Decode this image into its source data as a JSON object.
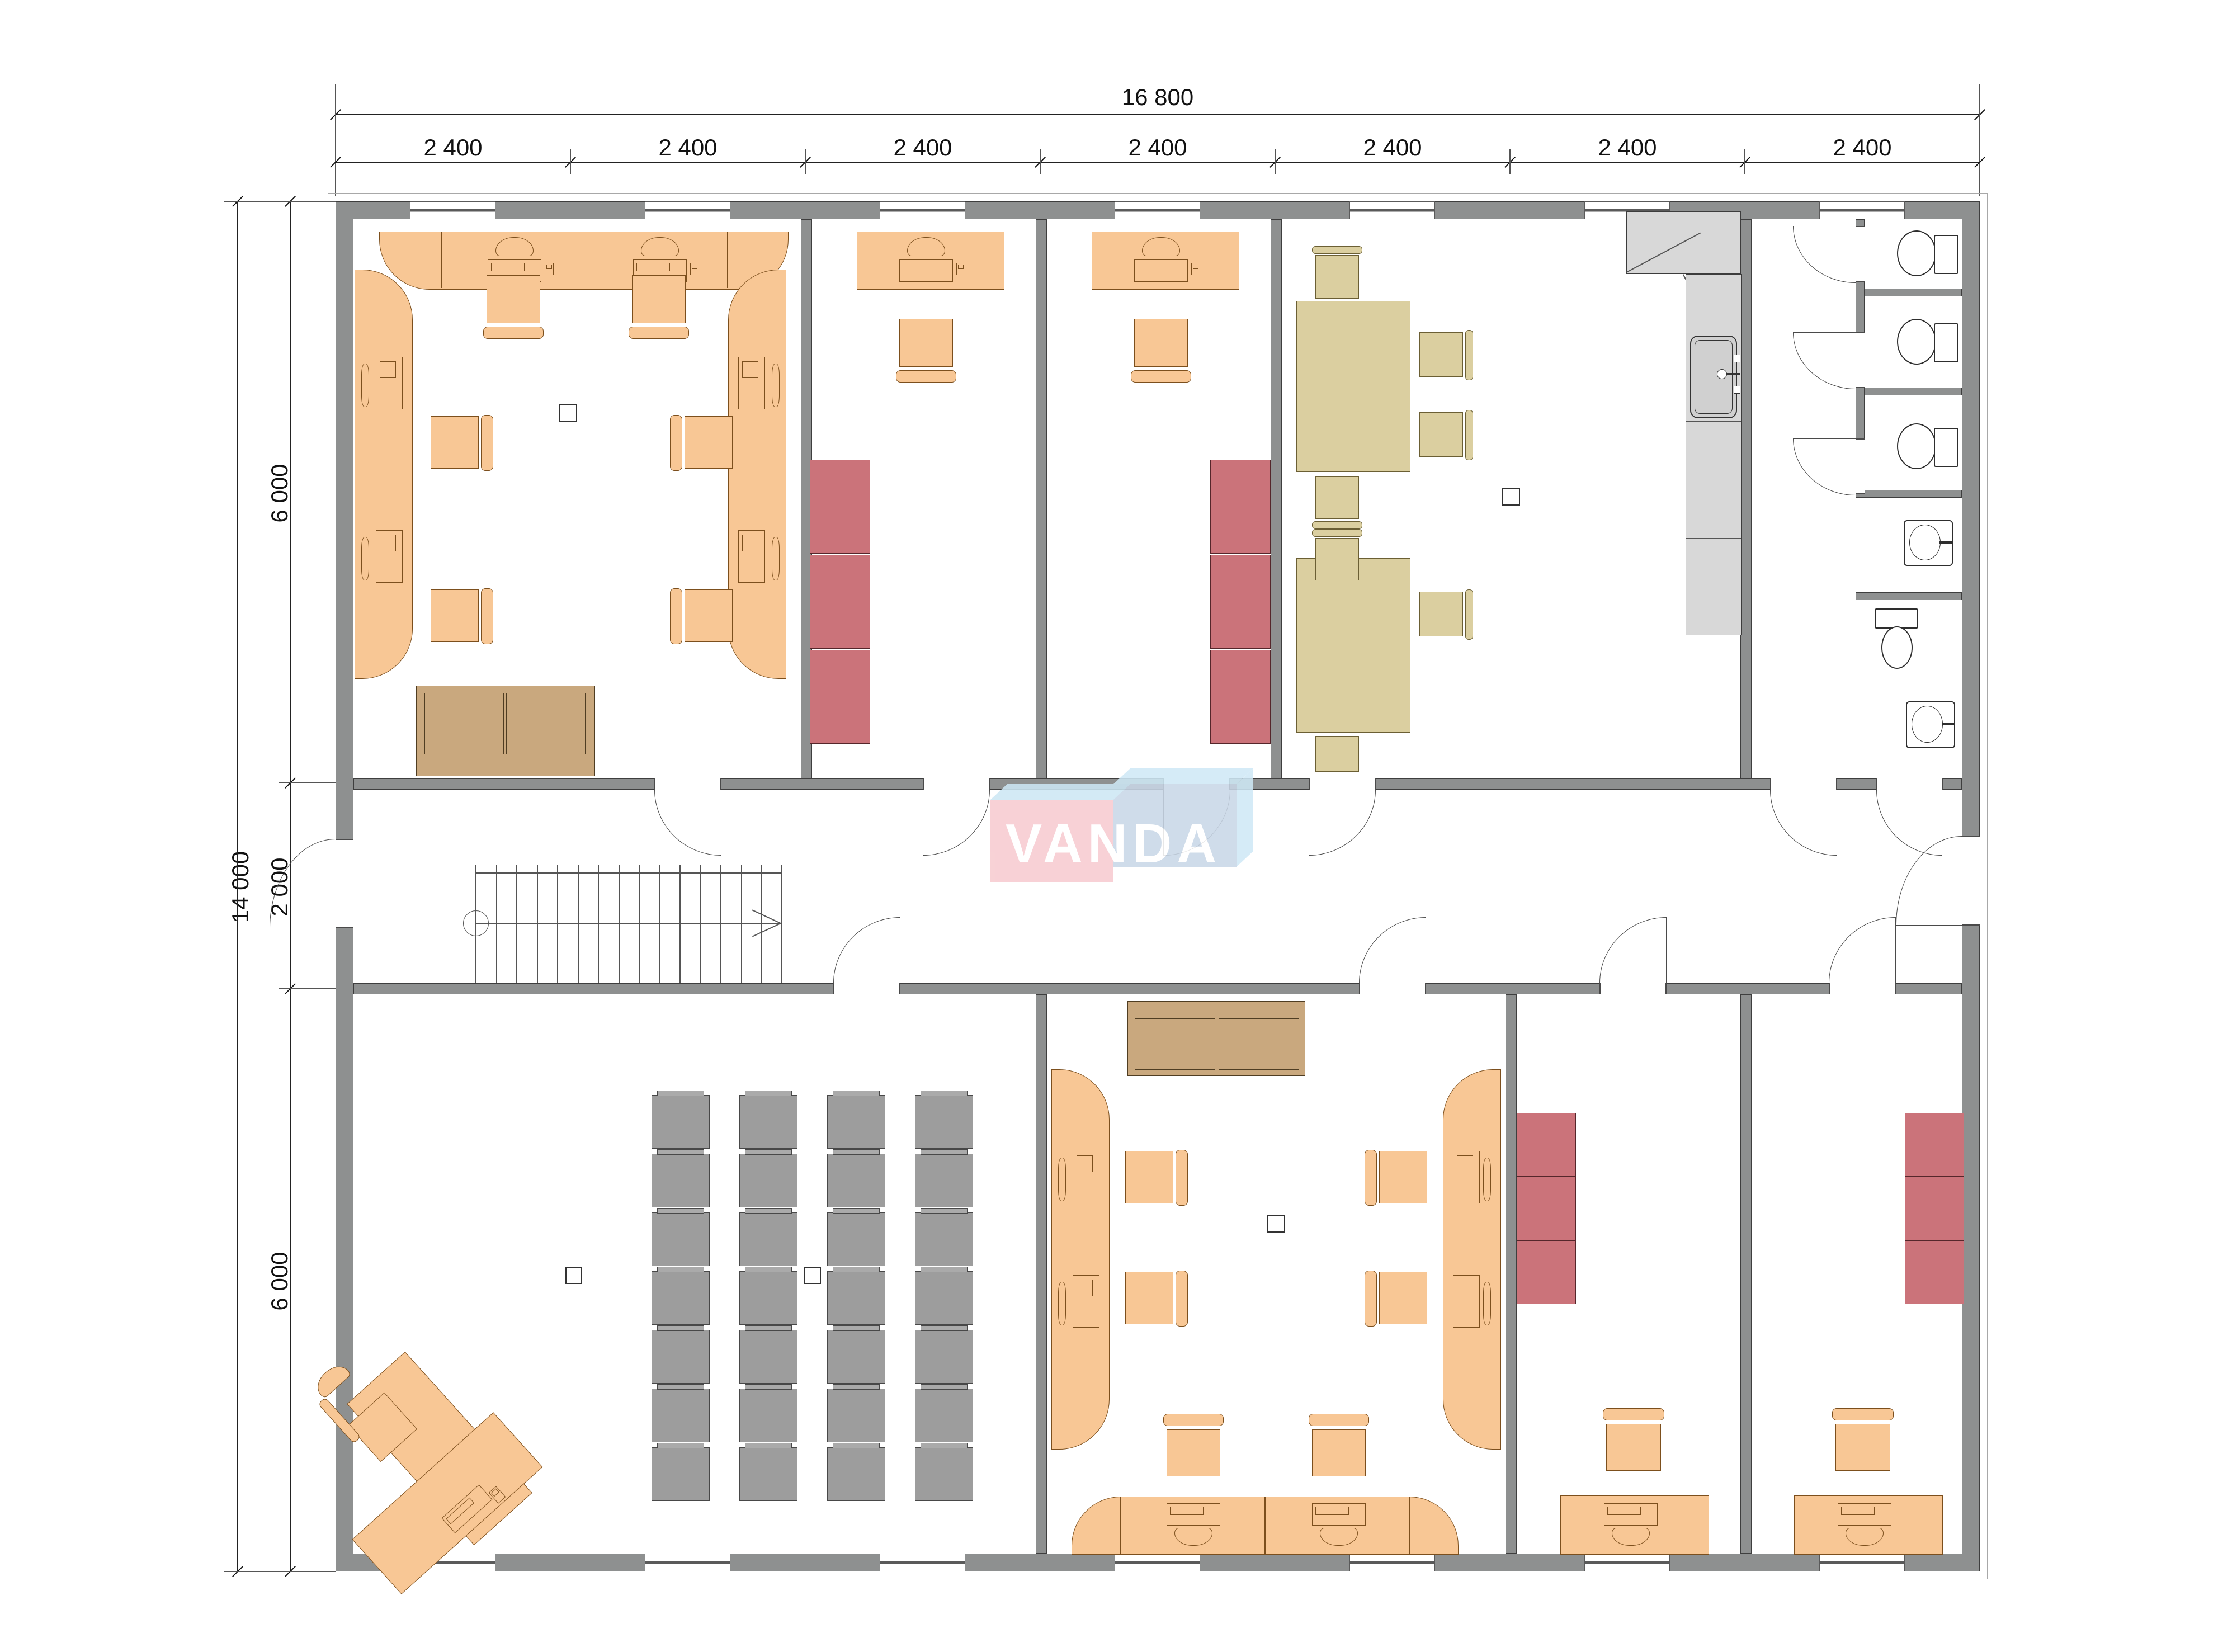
{
  "watermark": {
    "text": "VANDA",
    "pink": "#f7cbd0",
    "blue": "#c9d7e7",
    "pale_blue": "#cfe9f6"
  },
  "dimensions": {
    "top": {
      "total": "16 800",
      "segments": [
        "2 400",
        "2 400",
        "2 400",
        "2 400",
        "2 400",
        "2 400",
        "2 400"
      ]
    },
    "left": {
      "total": "14 000",
      "segments": [
        "6 000",
        "2 000",
        "6 000"
      ]
    }
  },
  "training_seating": {
    "rows": 7,
    "cols": 4
  },
  "stairs": {
    "treads": 15
  },
  "colors": {
    "wall": "#8e9090",
    "desk_orange": "#f8c795",
    "cabinet_red": "#cb737a",
    "table_tan": "#dbcfa0",
    "training_chair_gray": "#9d9d9d",
    "sofa_brown": "#c9a87e",
    "kitchen_counter_gray": "#d8d8d8"
  }
}
